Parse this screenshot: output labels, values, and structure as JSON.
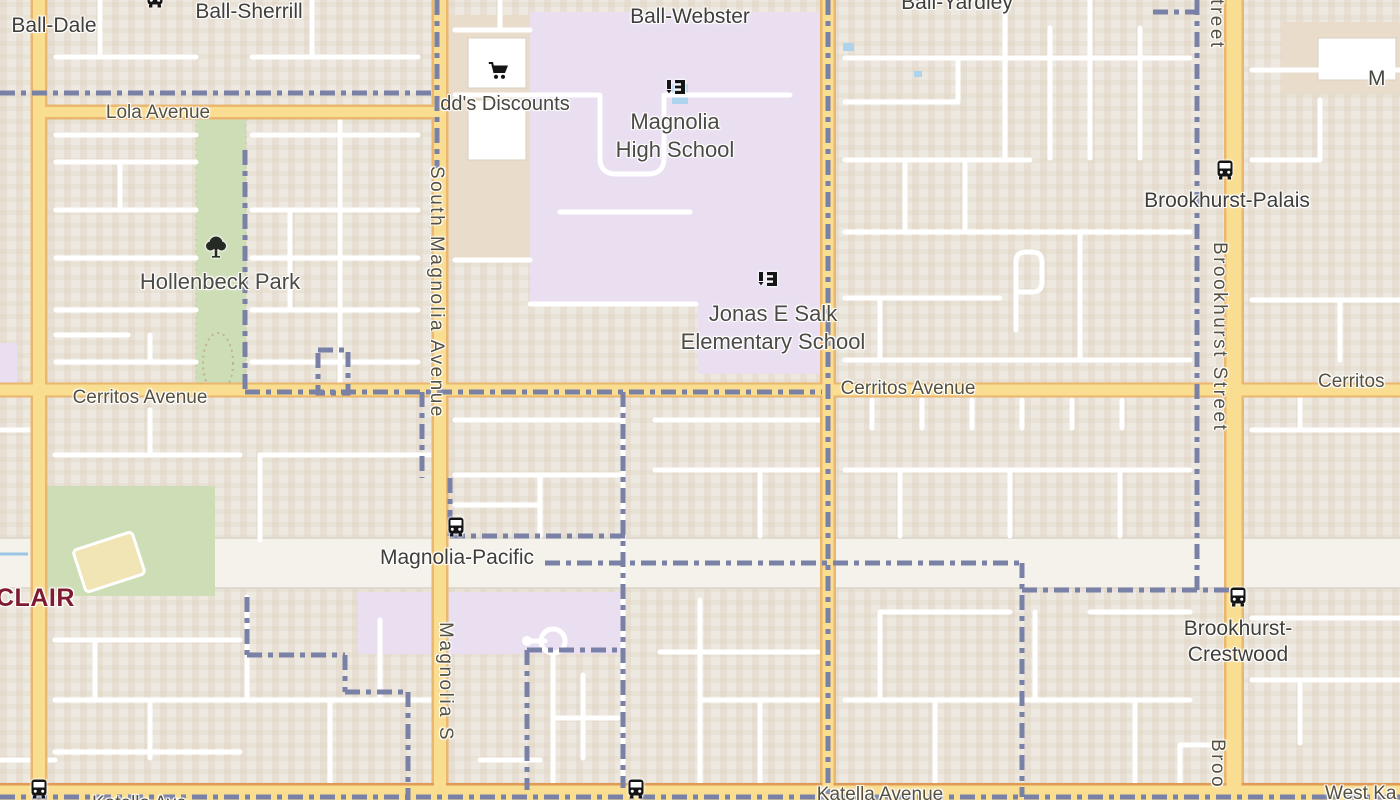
{
  "map": {
    "colors": {
      "bg": "#EDE9E1",
      "building": "#E3D5C3",
      "commercial": "#E9DCCB",
      "building_outline": "#D9CFC0",
      "road_yellow": "#F9DD90",
      "road_casing": "#EBB66D",
      "katella_casing": "#DF9A55",
      "white_road": "#FFFFFF",
      "boundary": "#7A81A6",
      "park": "#CDDDB6",
      "park_border": "#AFC490",
      "school_area": "#E9DFF1",
      "band": "#F5F2EB",
      "water": "#9CC4E4",
      "pool_blue": "#AED3EC",
      "label": "#47463F",
      "road_label": "#56503E",
      "neighborhood": "#7E1B30",
      "icon_black": "#151515"
    },
    "labels": {
      "ball_dale": {
        "text": "Ball-Dale"
      },
      "ball_sherrill": {
        "text": "Ball-Sherrill"
      },
      "ball_webster": {
        "text": "Ball-Webster"
      },
      "ball_yardley": {
        "text": "Ball-Yardley"
      },
      "lola_avenue": {
        "text": "Lola Avenue"
      },
      "dds_discounts": {
        "text": "dd's Discounts"
      },
      "magnolia_hs_line1": {
        "text": "Magnolia"
      },
      "magnolia_hs_line2": {
        "text": "High School"
      },
      "brookhurst_palais": {
        "text": "Brookhurst-Palais"
      },
      "hollenbeck_park": {
        "text": "Hollenbeck Park"
      },
      "salk_line1": {
        "text": "Jonas E Salk"
      },
      "salk_line2": {
        "text": "Elementary School"
      },
      "cerritos_left": {
        "text": "Cerritos Avenue"
      },
      "cerritos_center": {
        "text": "Cerritos Avenue"
      },
      "cerritos_right": {
        "text": "Cerritos"
      },
      "south_magnolia_avenue": {
        "text": "South Magnolia Avenue"
      },
      "brookhurst_street": {
        "text": "Brookhurst Street"
      },
      "brookhurst_street_top": {
        "text": "Street"
      },
      "brookhurst_street_bottom": {
        "text": "Broo"
      },
      "magnolia_street_bottom": {
        "text": "Magnolia S"
      },
      "magnolia_pacific": {
        "text": "Magnolia-Pacific"
      },
      "crestwood_line1": {
        "text": "Brookhurst-"
      },
      "crestwood_line2": {
        "text": "Crestwood"
      },
      "katella_avenue": {
        "text": "Katella Avenue"
      },
      "katella_partial": {
        "text": "Katella Ave"
      },
      "west_katella": {
        "text": "West Ka"
      },
      "clair": {
        "text": "CLAIR"
      },
      "m_partial": {
        "text": "M"
      }
    },
    "icons": {
      "bus_icon": "bus-stop glyph (black rounded bus, SVG)",
      "school_icon": "school glyph (black lectern + board, SVG)",
      "cart_icon": "shopping-cart glyph (black cart, SVG)",
      "tree_icon": "park tree glyph (dark tree, SVG)"
    }
  }
}
